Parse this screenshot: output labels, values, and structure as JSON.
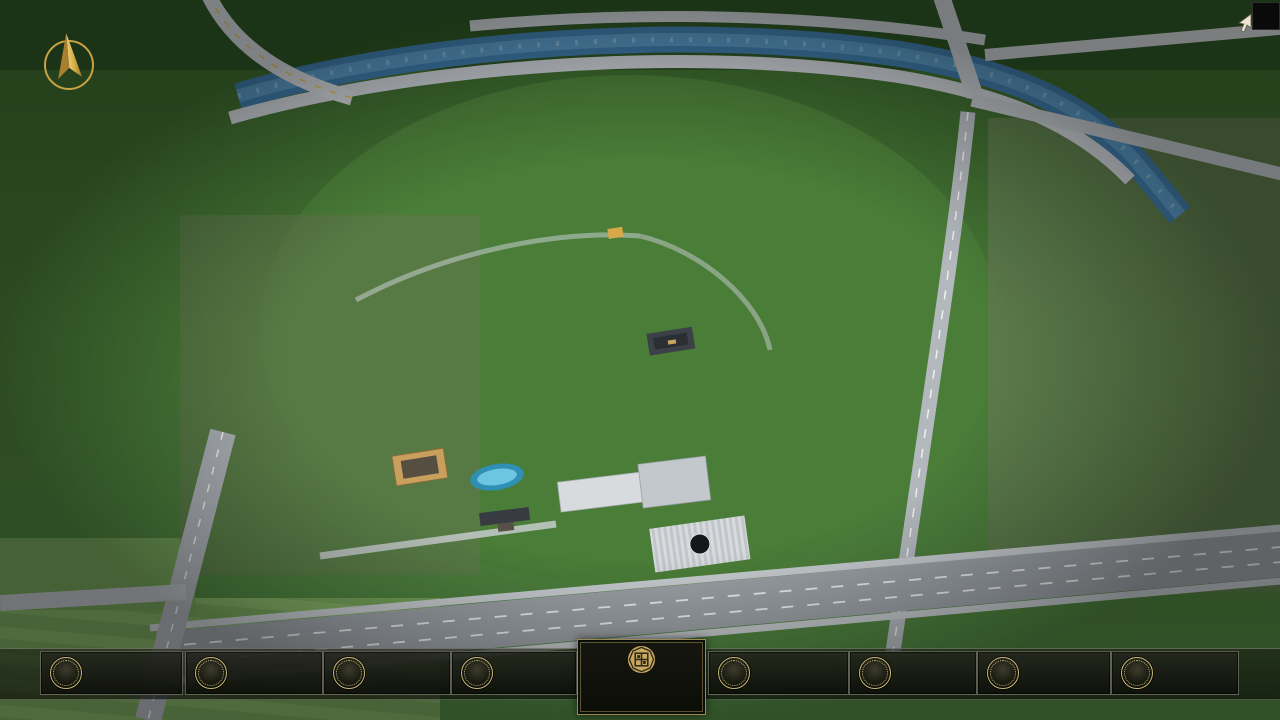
{
  "window": {
    "close_icon": "✕"
  },
  "menu": {
    "items": [
      {
        "num": "01",
        "label": "品牌 · 介绍",
        "sub": "BRAND SUPPORT"
      },
      {
        "num": "02",
        "label": "区位 · 价值",
        "sub": "LOCATION VALUE"
      },
      {
        "num": "03",
        "label": "项目 · 概况",
        "sub": "PROJECT SURVEY"
      },
      {
        "num": "04",
        "label": "建筑 · 鉴赏",
        "sub": "APPRECIATION"
      },
      {
        "num": "05",
        "label": "园林 · 景观",
        "sub": "GARDEN STREET"
      },
      {
        "num": "06",
        "label": "精装 · 体验",
        "sub": "EXPERIENCE"
      },
      {
        "num": "07",
        "label": "户型 · 分布",
        "sub": "SHOW ROOM"
      },
      {
        "num": "08",
        "label": "一房 · 一景",
        "sub": "COMMUNITY"
      }
    ]
  },
  "logo": {
    "title": "花語堂",
    "tagline": "· · · · · · · · · · · ·"
  },
  "footer": {
    "address": "地址：中国 · 山西"
  },
  "colors": {
    "gold_accent": "#c9b878",
    "panel_bg": "#14160f",
    "label_white": "#f5f5f1",
    "subtitle_gold": "#b3a265",
    "address_olive": "#626d45",
    "river_blue": "#3e78a5"
  }
}
